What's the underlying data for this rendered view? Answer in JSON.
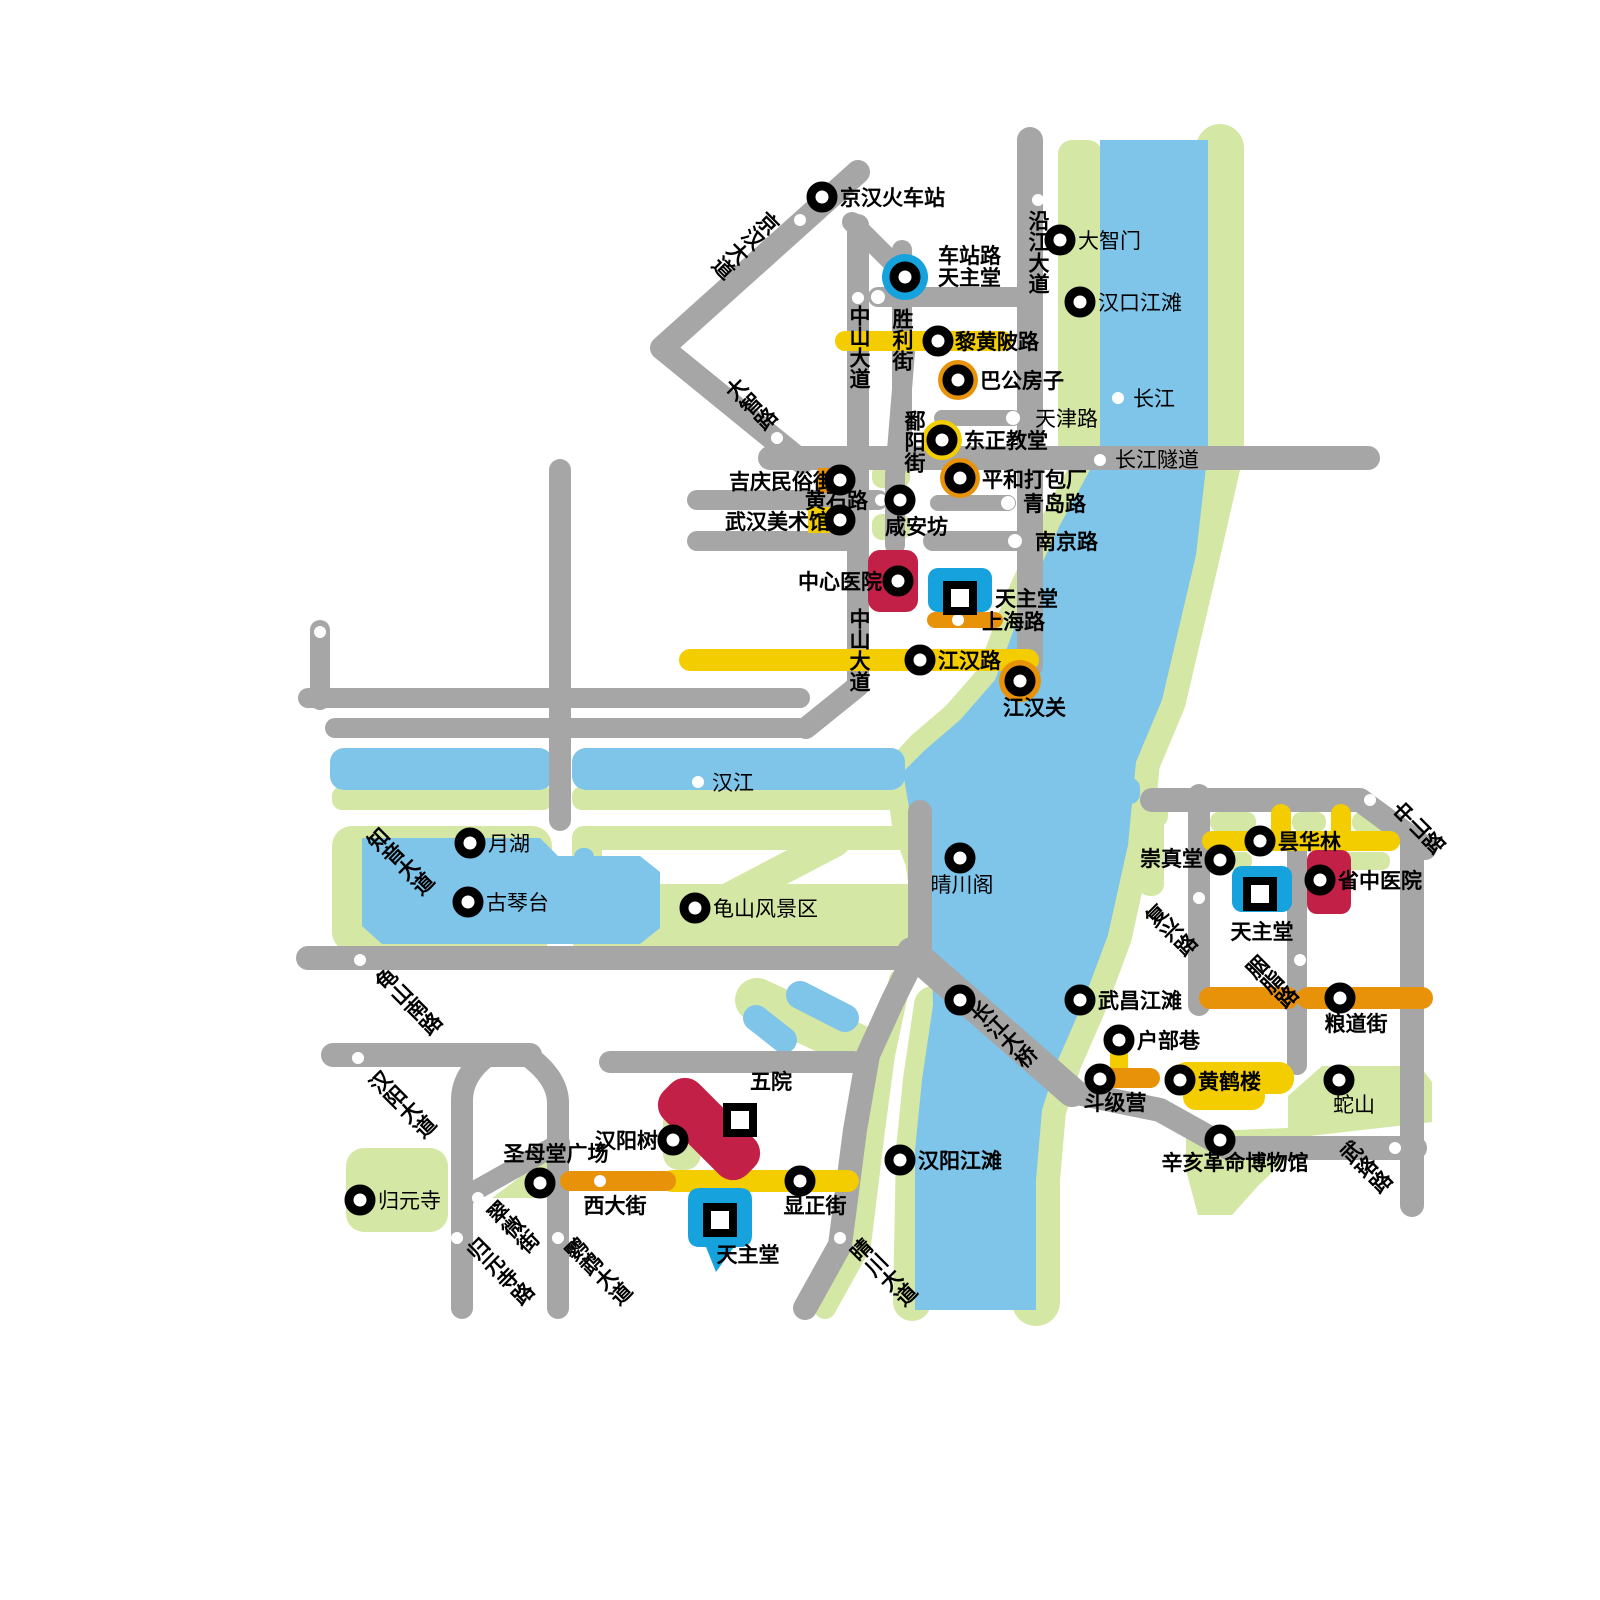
{
  "colors": {
    "road_gray": "#a6a6a6",
    "park_green": "#d5e7a5",
    "water_blue": "#7fc4e9",
    "highlight_yellow": "#f3cd00",
    "highlight_orange": "#e8920a",
    "marker_blue": "#16a2dc",
    "marker_red": "#c32047",
    "label_black": "#000000",
    "background": "#ffffff"
  },
  "icons": {
    "poi_marker": "black ring circle with white center",
    "church_marker": "black square outline with white center",
    "road_dot": "small white dot on road"
  },
  "water": {
    "changjiang": "长江",
    "hanjiang": "汉江"
  },
  "pois": {
    "jinghan_railway_station": "京汉火车站",
    "catholic_church_chezhanlu": "天主堂",
    "dazhimen": "大智门",
    "hankou_riverside": "汉口江滩",
    "bagong_house": "巴公房子",
    "orthodox_church": "东正教堂",
    "pinghe_packing_factory": "平和打包厂",
    "jiqing_folk_street": "吉庆民俗街",
    "xiananfang": "咸安坊",
    "wuhan_art_museum": "武汉美术馆",
    "central_hospital": "中心医院",
    "catholic_church_shanghailu": "天主堂",
    "jianghan_customs": "江汉关",
    "moon_lake": "月湖",
    "guqintai": "古琴台",
    "guishan_scenic_area": "龟山风景区",
    "qingchuan_pavilion": "晴川阁",
    "changjiang_bridge": "长江大桥",
    "wuchang_riverside": "武昌江滩",
    "hubu_alley": "户部巷",
    "doujiying": "斗级营",
    "yellow_crane_tower": "黄鹤楼",
    "snake_hill": "蛇山",
    "xinhai_revolution_museum": "辛亥革命博物馆",
    "chongzhen_church": "崇真堂",
    "tanhualin": "昙华林",
    "provincial_tcm_hospital": "省中医院",
    "catholic_church_wuchang": "天主堂",
    "guiyuan_temple": "归元寺",
    "shengmutang_square": "圣母堂广场",
    "hanyang_tree": "汉阳树",
    "fifth_hospital": "五院",
    "catholic_church_hanyang": "天主堂",
    "hanyang_riverside": "汉阳江滩"
  },
  "roads": {
    "jinghan_avenue": "京汉大道",
    "dazhi_road": "大智路",
    "yanjiang_avenue": "沿江大道",
    "zhongshan_avenue": "中山大道",
    "zhongshan_avenue_2": "中山大道",
    "shengli_street": "胜利街",
    "poyang_street": "鄱阳街",
    "chezhan_road": "车站路",
    "lihuangpi_road": "黎黄陂路",
    "tianjin_road": "天津路",
    "qingdao_road": "青岛路",
    "nanjing_road": "南京路",
    "huangshi_road": "黄石路",
    "shanghai_road": "上海路",
    "jianghan_road": "江汉路",
    "changjiang_tunnel": "长江隧道",
    "zhiyin_avenue": "知音大道",
    "guishan_south_road": "龟山南路",
    "hanyang_avenue": "汉阳大道",
    "cuiwei_street": "翠微街",
    "guiyuansi_road": "归元寺路",
    "yingwu_avenue": "鹦鹉大道",
    "qingchuan_avenue": "晴川大道",
    "zhongshan_road": "中山路",
    "fuxing_road": "复兴路",
    "yanzhi_road": "胭脂路",
    "wuluo_road": "武珞路",
    "xi_street": "西大街",
    "xianzheng_street": "显正街",
    "liangdao_street": "粮道街"
  }
}
